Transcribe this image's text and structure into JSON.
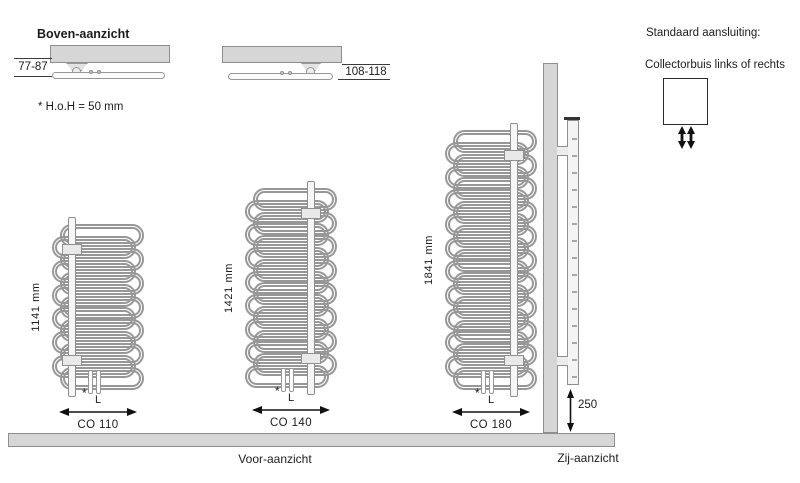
{
  "top_view": {
    "title": "Boven-aanzicht",
    "note": "* H.o.H = 50 mm",
    "left_unit_dim": "77-87",
    "right_unit_dim": "108-118"
  },
  "standard_connection": {
    "title": "Standaard aansluiting:",
    "subtitle": "Collectorbuis links of rechts"
  },
  "front_view_label": "Voor-aanzicht",
  "side_view": {
    "label": "Zij-aanzicht",
    "floor_clearance": "250"
  },
  "radiators": [
    {
      "model": "CO 110",
      "height_label": "1141 mm",
      "width_label": "L",
      "asterisk": "*",
      "geom": {
        "left": 52,
        "top": 224,
        "width": 92,
        "h": 166,
        "loops": 13,
        "collector_x": 16
      }
    },
    {
      "model": "CO 140",
      "height_label": "1421 mm",
      "width_label": "L",
      "asterisk": "*",
      "geom": {
        "left": 245,
        "top": 188,
        "width": 92,
        "h": 200,
        "loops": 16,
        "collector_x": 62
      }
    },
    {
      "model": "CO 180",
      "height_label": "1841 mm",
      "width_label": "L",
      "asterisk": "*",
      "geom": {
        "left": 445,
        "top": 130,
        "width": 92,
        "h": 260,
        "loops": 21,
        "collector_x": 65
      }
    }
  ],
  "colors": {
    "line": "#979797",
    "fill_gray": "#d6d6d6",
    "text": "#1c1c1c",
    "arrow": "#111111"
  }
}
